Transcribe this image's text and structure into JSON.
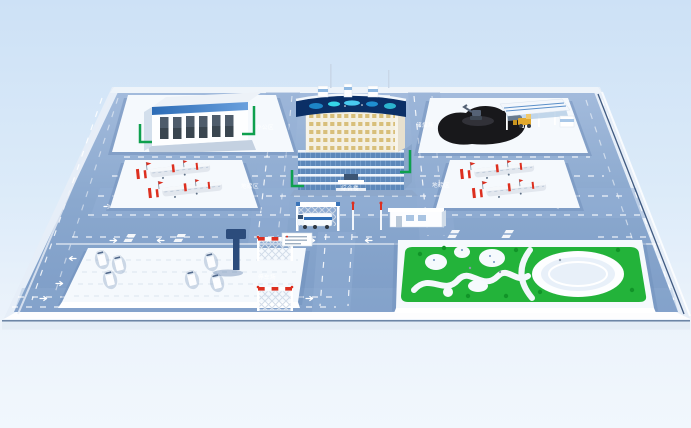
{
  "labels": {
    "office_area": "办公区",
    "coal_yard": "储煤场",
    "weighbridge_left": "地磅区",
    "weighbridge_right": "地磅区",
    "main_building": "综合楼",
    "parking_lot": "停车场"
  },
  "palette": {
    "bgTop": "#cfe2f6",
    "bgBottom": "#f0f6fc",
    "platformTop": "#a3bbdc",
    "platformBottom": "#7e9dc7",
    "road": "#93b0d5",
    "pad": "#f5f9fd",
    "green": "#23b33a",
    "curb": "#0ea04e",
    "coal": "#18181b",
    "screen": "#0b2f66",
    "glow": "#35d6e8",
    "red": "#dd2f1f",
    "yellow": "#e2a92e",
    "navy": "#223f6b"
  }
}
